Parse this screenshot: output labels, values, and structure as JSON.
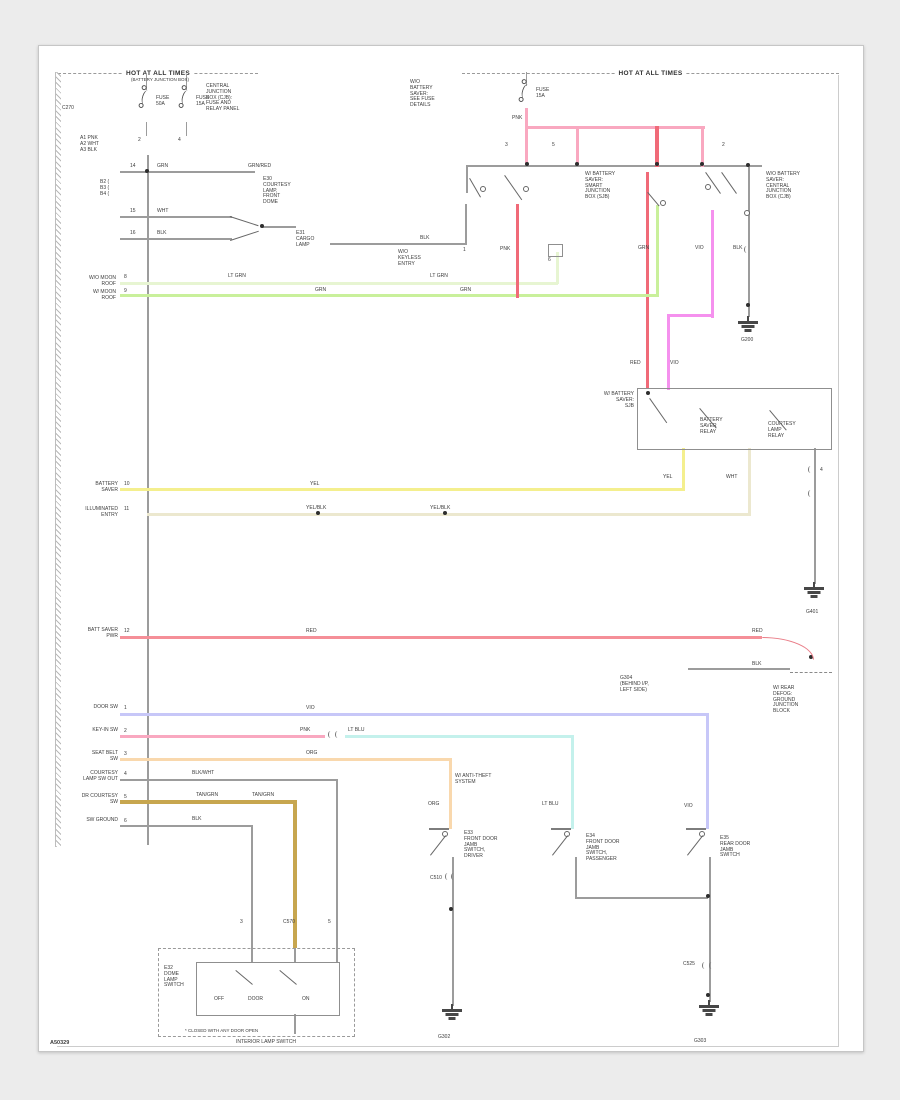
{
  "palette": {
    "pink": "#f9a8c0",
    "redpink": "#f06a78",
    "red": "#f58f98",
    "palegrn": "#e7f5d2",
    "ltgrn": "#c9f09b",
    "yellow": "#f4ef8e",
    "paleyel": "#ece8cf",
    "magenta": "#f591ee",
    "violet": "#c7c7f8",
    "cyan": "#c4f1ec",
    "orange": "#f9d8ad",
    "tan": "#c7a64f",
    "gray": "#9c9c9c",
    "frame": "#cccccc",
    "dark": "#474747"
  },
  "headers": {
    "left_title": "HOT AT ALL TIMES",
    "left_sub": "(BATTERY JUNCTION BOX)",
    "right_title": "HOT AT ALL TIMES"
  },
  "footer": {
    "code": "A50329",
    "caption": "INTERIOR LAMP SWITCH"
  },
  "figure": {
    "wires": [
      [
        120,
        171,
        135,
        2,
        "gray"
      ],
      [
        120,
        216,
        112,
        2,
        "gray"
      ],
      [
        120,
        238,
        112,
        2,
        "gray"
      ],
      [
        262,
        226,
        34,
        2,
        "gray"
      ],
      [
        330,
        243,
        136,
        2,
        "gray"
      ],
      [
        465,
        204,
        2,
        41,
        "gray"
      ],
      [
        466,
        165,
        2,
        28,
        "gray"
      ],
      [
        147,
        155,
        2,
        690,
        "gray"
      ],
      [
        466,
        165,
        296,
        2,
        "gray"
      ],
      [
        146,
        74,
        1,
        16,
        "gray"
      ],
      [
        186,
        74,
        1,
        16,
        "gray"
      ],
      [
        146,
        122,
        1,
        14,
        "gray"
      ],
      [
        186,
        122,
        1,
        14,
        "gray"
      ],
      [
        526,
        72,
        1,
        14,
        "gray"
      ],
      [
        525,
        108,
        3,
        20,
        "pink"
      ],
      [
        525,
        126,
        180,
        3,
        "pink"
      ],
      [
        525,
        126,
        3,
        39,
        "pink"
      ],
      [
        576,
        126,
        3,
        39,
        "pink"
      ],
      [
        655,
        126,
        4,
        41,
        "redpink"
      ],
      [
        701,
        126,
        3,
        41,
        "pink"
      ],
      [
        646,
        172,
        3,
        216,
        "redpink"
      ],
      [
        711,
        210,
        3,
        108,
        "magenta"
      ],
      [
        668,
        314,
        46,
        3,
        "magenta"
      ],
      [
        667,
        314,
        3,
        76,
        "magenta"
      ],
      [
        748,
        167,
        2,
        150,
        "gray"
      ],
      [
        120,
        282,
        438,
        3,
        "palegrn"
      ],
      [
        556,
        252,
        3,
        32,
        "palegrn"
      ],
      [
        120,
        294,
        539,
        3,
        "ltgrn"
      ],
      [
        656,
        205,
        3,
        92,
        "ltgrn"
      ],
      [
        516,
        204,
        3,
        94,
        "redpink"
      ],
      [
        120,
        488,
        565,
        3,
        "yellow"
      ],
      [
        682,
        448,
        3,
        42,
        "yellow"
      ],
      [
        147,
        513,
        604,
        3,
        "paleyel"
      ],
      [
        748,
        448,
        3,
        67,
        "paleyel"
      ],
      [
        814,
        448,
        2,
        136,
        "gray"
      ],
      [
        120,
        636,
        642,
        3,
        "red"
      ],
      [
        688,
        668,
        102,
        2,
        "gray"
      ],
      [
        120,
        713,
        589,
        3,
        "violet"
      ],
      [
        706,
        713,
        3,
        116,
        "violet"
      ],
      [
        120,
        735,
        205,
        3,
        "pink"
      ],
      [
        345,
        735,
        229,
        3,
        "cyan"
      ],
      [
        571,
        735,
        3,
        94,
        "cyan"
      ],
      [
        120,
        758,
        332,
        3,
        "orange"
      ],
      [
        449,
        758,
        3,
        71,
        "orange"
      ],
      [
        120,
        779,
        218,
        2,
        "gray"
      ],
      [
        336,
        779,
        2,
        169,
        "gray"
      ],
      [
        120,
        800,
        176,
        4,
        "tan"
      ],
      [
        293,
        800,
        4,
        148,
        "tan"
      ],
      [
        120,
        825,
        133,
        2,
        "gray"
      ],
      [
        251,
        825,
        2,
        123,
        "gray"
      ],
      [
        452,
        857,
        2,
        149,
        "gray"
      ],
      [
        575,
        857,
        2,
        42,
        "gray"
      ],
      [
        575,
        897,
        133,
        2,
        "gray"
      ],
      [
        709,
        857,
        2,
        145,
        "gray"
      ],
      [
        294,
        948,
        2,
        15,
        "gray"
      ],
      [
        251,
        948,
        2,
        15,
        "gray"
      ],
      [
        336,
        948,
        2,
        15,
        "gray"
      ],
      [
        294,
        1014,
        2,
        20,
        "gray"
      ],
      [
        838,
        75,
        1,
        971,
        "frame"
      ],
      [
        57,
        1046,
        782,
        1,
        "frame"
      ]
    ],
    "boxes": [
      [
        637,
        388,
        193,
        60,
        0
      ],
      [
        548,
        244,
        13,
        11,
        0
      ],
      [
        158,
        948,
        195,
        87,
        1
      ],
      [
        196,
        962,
        142,
        52,
        0
      ]
    ],
    "labels": [
      {
        "x": 105,
        "y": 77,
        "w": 110,
        "a": "c",
        "t": "(BATTERY JUNCTION BOX)",
        "s": 4.5
      },
      {
        "x": 156,
        "y": 96,
        "t": "FUSE\n50A"
      },
      {
        "x": 196,
        "y": 96,
        "t": "FUSE\n15A"
      },
      {
        "x": 138,
        "y": 138,
        "t": "2"
      },
      {
        "x": 178,
        "y": 138,
        "t": "4"
      },
      {
        "x": 206,
        "y": 84,
        "t": "CENTRAL\nJUNCTION\nBOX (CJB):\nFUSE AND\nRELAY PANEL"
      },
      {
        "x": 62,
        "y": 106,
        "t": "C270"
      },
      {
        "x": 80,
        "y": 136,
        "t": "A1  PNK\nA2  WHT\nA3  BLK"
      },
      {
        "x": 100,
        "y": 180,
        "t": "B2 (\nB3 (\nB4 ("
      },
      {
        "x": 130,
        "y": 164,
        "t": "14"
      },
      {
        "x": 157,
        "y": 164,
        "t": "GRN"
      },
      {
        "x": 248,
        "y": 164,
        "t": "GRN/RED"
      },
      {
        "x": 263,
        "y": 177,
        "t": "E30\nCOURTESY\nLAMP,\nFRONT\nDOME"
      },
      {
        "x": 130,
        "y": 209,
        "t": "15"
      },
      {
        "x": 157,
        "y": 209,
        "t": "WHT"
      },
      {
        "x": 130,
        "y": 231,
        "t": "16"
      },
      {
        "x": 157,
        "y": 231,
        "t": "BLK"
      },
      {
        "x": 296,
        "y": 231,
        "t": "E31\nCARGO\nLAMP"
      },
      {
        "x": 420,
        "y": 236,
        "t": "BLK"
      },
      {
        "x": 58,
        "y": 276,
        "w": 58,
        "a": "r",
        "t": "W/O MOON\nROOF"
      },
      {
        "x": 124,
        "y": 275,
        "t": "8"
      },
      {
        "x": 228,
        "y": 274,
        "t": "LT GRN"
      },
      {
        "x": 430,
        "y": 274,
        "t": "LT GRN"
      },
      {
        "x": 58,
        "y": 290,
        "w": 58,
        "a": "r",
        "t": "W/ MOON\nROOF"
      },
      {
        "x": 124,
        "y": 289,
        "t": "9"
      },
      {
        "x": 315,
        "y": 288,
        "t": "GRN"
      },
      {
        "x": 460,
        "y": 288,
        "t": "GRN"
      },
      {
        "x": 505,
        "y": 143,
        "t": "3"
      },
      {
        "x": 552,
        "y": 143,
        "t": "5"
      },
      {
        "x": 722,
        "y": 143,
        "t": "2"
      },
      {
        "x": 463,
        "y": 248,
        "t": "1"
      },
      {
        "x": 500,
        "y": 247,
        "t": "PNK"
      },
      {
        "x": 548,
        "y": 258,
        "t": "6"
      },
      {
        "x": 585,
        "y": 172,
        "t": "W/ BATTERY\nSAVER:\nSMART\nJUNCTION\nBOX (SJB)"
      },
      {
        "x": 766,
        "y": 172,
        "t": "W/O BATTERY\nSAVER:\nCENTRAL\nJUNCTION\nBOX (CJB)"
      },
      {
        "x": 638,
        "y": 246,
        "t": "GRN"
      },
      {
        "x": 695,
        "y": 246,
        "t": "VIO"
      },
      {
        "x": 733,
        "y": 246,
        "t": "BLK"
      },
      {
        "x": 741,
        "y": 338,
        "t": "G200"
      },
      {
        "x": 410,
        "y": 80,
        "t": "W/O\nBATTERY\nSAVER:\nSEE FUSE\nDETAILS"
      },
      {
        "x": 536,
        "y": 88,
        "t": "FUSE\n15A"
      },
      {
        "x": 512,
        "y": 116,
        "t": "PNK"
      },
      {
        "x": 398,
        "y": 250,
        "t": "W/O\nKEYLESS\nENTRY"
      },
      {
        "x": 630,
        "y": 361,
        "t": "RED"
      },
      {
        "x": 670,
        "y": 361,
        "t": "VIO"
      },
      {
        "x": 578,
        "y": 392,
        "w": 56,
        "a": "r",
        "t": "W/ BATTERY\nSAVER:\nSJB"
      },
      {
        "x": 700,
        "y": 418,
        "t": "BATTERY\nSAVER\nRELAY"
      },
      {
        "x": 768,
        "y": 422,
        "t": "COURTESY\nLAMP\nRELAY"
      },
      {
        "x": 663,
        "y": 475,
        "t": "YEL"
      },
      {
        "x": 726,
        "y": 475,
        "t": "WHT"
      },
      {
        "x": 820,
        "y": 468,
        "t": "4"
      },
      {
        "x": 806,
        "y": 610,
        "t": "G401"
      },
      {
        "x": 56,
        "y": 482,
        "w": 62,
        "a": "r",
        "t": "BATTERY\nSAVER"
      },
      {
        "x": 124,
        "y": 482,
        "t": "10"
      },
      {
        "x": 310,
        "y": 482,
        "t": "YEL"
      },
      {
        "x": 56,
        "y": 507,
        "w": 62,
        "a": "r",
        "t": "ILLUMINATED\nENTRY"
      },
      {
        "x": 124,
        "y": 507,
        "t": "11"
      },
      {
        "x": 306,
        "y": 506,
        "t": "YEL/BLK"
      },
      {
        "x": 430,
        "y": 506,
        "t": "YEL/BLK"
      },
      {
        "x": 54,
        "y": 628,
        "w": 64,
        "a": "r",
        "t": "BATT SAVER\nPWR"
      },
      {
        "x": 124,
        "y": 629,
        "t": "12"
      },
      {
        "x": 306,
        "y": 629,
        "t": "RED"
      },
      {
        "x": 752,
        "y": 629,
        "t": "RED"
      },
      {
        "x": 752,
        "y": 662,
        "t": "BLK"
      },
      {
        "x": 620,
        "y": 676,
        "t": "G304\n(BEHIND I/P,\nLEFT SIDE)"
      },
      {
        "x": 773,
        "y": 686,
        "t": "W/ REAR\nDEFOG:\nGROUND\nJUNCTION\nBLOCK"
      },
      {
        "x": 56,
        "y": 705,
        "w": 62,
        "a": "r",
        "t": "DOOR SW"
      },
      {
        "x": 124,
        "y": 706,
        "t": "1"
      },
      {
        "x": 306,
        "y": 706,
        "t": "VIO"
      },
      {
        "x": 684,
        "y": 804,
        "t": "VIO"
      },
      {
        "x": 56,
        "y": 728,
        "w": 62,
        "a": "r",
        "t": "KEY-IN SW"
      },
      {
        "x": 124,
        "y": 729,
        "t": "2"
      },
      {
        "x": 300,
        "y": 728,
        "t": "PNK"
      },
      {
        "x": 348,
        "y": 728,
        "t": "LT BLU"
      },
      {
        "x": 542,
        "y": 802,
        "t": "LT BLU"
      },
      {
        "x": 54,
        "y": 751,
        "w": 64,
        "a": "r",
        "t": "SEAT BELT\nSW"
      },
      {
        "x": 124,
        "y": 752,
        "t": "3"
      },
      {
        "x": 306,
        "y": 751,
        "t": "ORG"
      },
      {
        "x": 428,
        "y": 802,
        "t": "ORG"
      },
      {
        "x": 455,
        "y": 774,
        "t": "W/ ANTI-THEFT\nSYSTEM"
      },
      {
        "x": 50,
        "y": 771,
        "w": 68,
        "a": "r",
        "t": "COURTESY\nLAMP SW OUT"
      },
      {
        "x": 124,
        "y": 772,
        "t": "4"
      },
      {
        "x": 192,
        "y": 771,
        "t": "BLK/WHT"
      },
      {
        "x": 50,
        "y": 794,
        "w": 68,
        "a": "r",
        "t": "DR COURTESY\nSW"
      },
      {
        "x": 124,
        "y": 795,
        "t": "5"
      },
      {
        "x": 196,
        "y": 793,
        "t": "TAN/GRN"
      },
      {
        "x": 252,
        "y": 793,
        "t": "TAN/GRN"
      },
      {
        "x": 50,
        "y": 818,
        "w": 68,
        "a": "r",
        "t": "SW GROUND"
      },
      {
        "x": 124,
        "y": 819,
        "t": "6"
      },
      {
        "x": 192,
        "y": 817,
        "t": "BLK"
      },
      {
        "x": 240,
        "y": 920,
        "t": "3"
      },
      {
        "x": 283,
        "y": 920,
        "t": "C570"
      },
      {
        "x": 328,
        "y": 920,
        "t": "5"
      },
      {
        "x": 164,
        "y": 966,
        "t": "E32\nDOME\nLAMP\nSWITCH"
      },
      {
        "x": 214,
        "y": 997,
        "t": "OFF"
      },
      {
        "x": 248,
        "y": 997,
        "t": "DOOR"
      },
      {
        "x": 302,
        "y": 997,
        "t": "ON"
      },
      {
        "x": 185,
        "y": 1028,
        "t": "* CLOSED WITH ANY DOOR OPEN",
        "s": 4.5
      },
      {
        "x": 464,
        "y": 831,
        "t": "E33\nFRONT DOOR\nJAMB\nSWITCH,\nDRIVER"
      },
      {
        "x": 586,
        "y": 834,
        "t": "E34\nFRONT DOOR\nJAMB\nSWITCH,\nPASSENGER"
      },
      {
        "x": 720,
        "y": 836,
        "t": "E35\nREAR DOOR\nJAMB\nSWITCH"
      },
      {
        "x": 430,
        "y": 876,
        "t": "C510"
      },
      {
        "x": 683,
        "y": 962,
        "t": "C525"
      },
      {
        "x": 438,
        "y": 1035,
        "t": "G302"
      },
      {
        "x": 694,
        "y": 1039,
        "t": "G303"
      }
    ],
    "dots": [
      [
        147,
        171
      ],
      [
        262,
        226
      ],
      [
        527,
        164
      ],
      [
        577,
        164
      ],
      [
        657,
        164
      ],
      [
        702,
        164
      ],
      [
        748,
        165
      ],
      [
        648,
        393
      ],
      [
        811,
        657
      ],
      [
        748,
        305
      ],
      [
        451,
        909
      ],
      [
        708,
        896
      ],
      [
        708,
        995
      ],
      [
        318,
        513
      ],
      [
        445,
        513
      ]
    ],
    "circles": [
      [
        480,
        186
      ],
      [
        523,
        186
      ],
      [
        660,
        200
      ],
      [
        705,
        184
      ],
      [
        744,
        210
      ]
    ],
    "levers": [
      [
        470,
        178,
        22,
        60
      ],
      [
        505,
        175,
        30,
        55
      ],
      [
        648,
        192,
        18,
        50
      ],
      [
        706,
        172,
        26,
        55
      ],
      [
        722,
        172,
        26,
        55
      ],
      [
        650,
        398,
        30,
        55
      ],
      [
        700,
        408,
        26,
        50
      ],
      [
        770,
        410,
        26,
        50
      ],
      [
        236,
        970,
        22,
        40
      ],
      [
        280,
        970,
        22,
        40
      ],
      [
        230,
        216,
        30,
        18
      ],
      [
        230,
        240,
        30,
        -18
      ]
    ],
    "ticks": [
      [
        328,
        731
      ],
      [
        335,
        731
      ],
      [
        445,
        873
      ],
      [
        451,
        873
      ],
      [
        702,
        962
      ],
      [
        709,
        962
      ],
      [
        808,
        466
      ],
      [
        808,
        490
      ],
      [
        744,
        246
      ]
    ],
    "fuses": [
      [
        142,
        90
      ],
      [
        182,
        90
      ],
      [
        522,
        84
      ]
    ],
    "grounds": [
      [
        735,
        316
      ],
      [
        801,
        582
      ],
      [
        439,
        1004
      ],
      [
        696,
        1000
      ]
    ],
    "switches": [
      [
        449,
        828
      ],
      [
        571,
        828
      ],
      [
        706,
        828
      ]
    ],
    "dashes": [
      [
        790,
        672,
        42
      ]
    ],
    "hooks": [
      [
        762,
        637,
        50,
        21
      ]
    ]
  }
}
